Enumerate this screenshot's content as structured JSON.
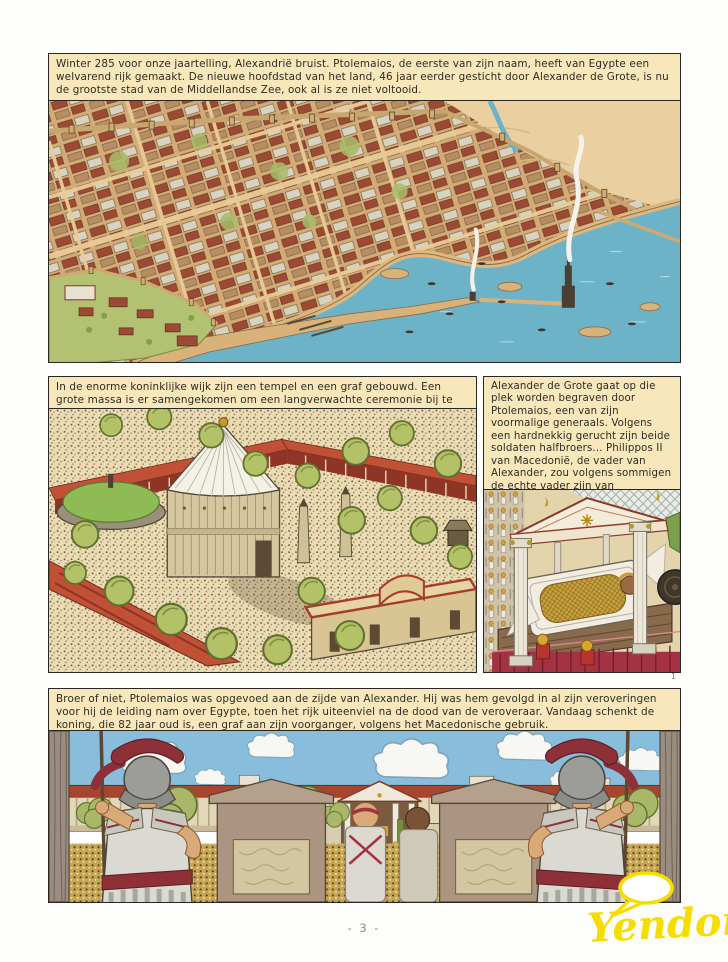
{
  "page": {
    "number_label": "- 3 -",
    "plate_number": "1",
    "publisher_logo": "Yendor"
  },
  "panels": [
    {
      "id": "alexandria-aerial",
      "caption": "Winter 285 voor onze jaartelling, Alexandrië bruist. Ptolemaios, de eerste van zijn naam, heeft van Egypte een welvarend rijk gemaakt. De nieuwe hoofdstad van het land, 46 jaar eerder gesticht door Alexander de Grote, is nu de grootste stad van de Middellandse Zee, ook al is ze niet voltooid."
    },
    {
      "id": "royal-quarter",
      "caption": "In de enorme koninklijke wijk zijn een tempel en een graf gebouwd. Een grote massa is er samengekomen om een langverwachte ceremonie bij te wonen."
    },
    {
      "id": "tomb-interior",
      "caption": "Alexander de Grote gaat op die plek worden begraven door Ptolemaios, een van zijn voormalige generaals. Volgens een hardnekkig gerucht zijn beide soldaten halfbroers... Philippos II van Macedonië, de vader van Alexander, zou volgens sommigen de echte vader zijn van Ptolemaios..."
    },
    {
      "id": "ceremony-view",
      "caption": "Broer of niet, Ptolemaios was opgevoed aan de zijde van Alexander. Hij was hem gevolgd in al zijn veroveringen voor hij de leiding nam over Egypte, toen het rijk uiteenviel na de dood van de veroveraar. Vandaag schenkt de koning, die 82 jaar oud is, een graf aan zijn voorganger, volgens het Macedonische gebruik."
    }
  ],
  "palette": {
    "caption_bg": "#f7e7ba",
    "panel_border": "#29261f",
    "water_blue": "#6cb3c8",
    "sand_tan": "#d9b279",
    "roof_red": "#a8452f",
    "tree_green": "#b4c267",
    "sky_blue": "#88bedb",
    "crowd_gold": "#c5a452",
    "logo_yellow": "#f6dd00"
  }
}
